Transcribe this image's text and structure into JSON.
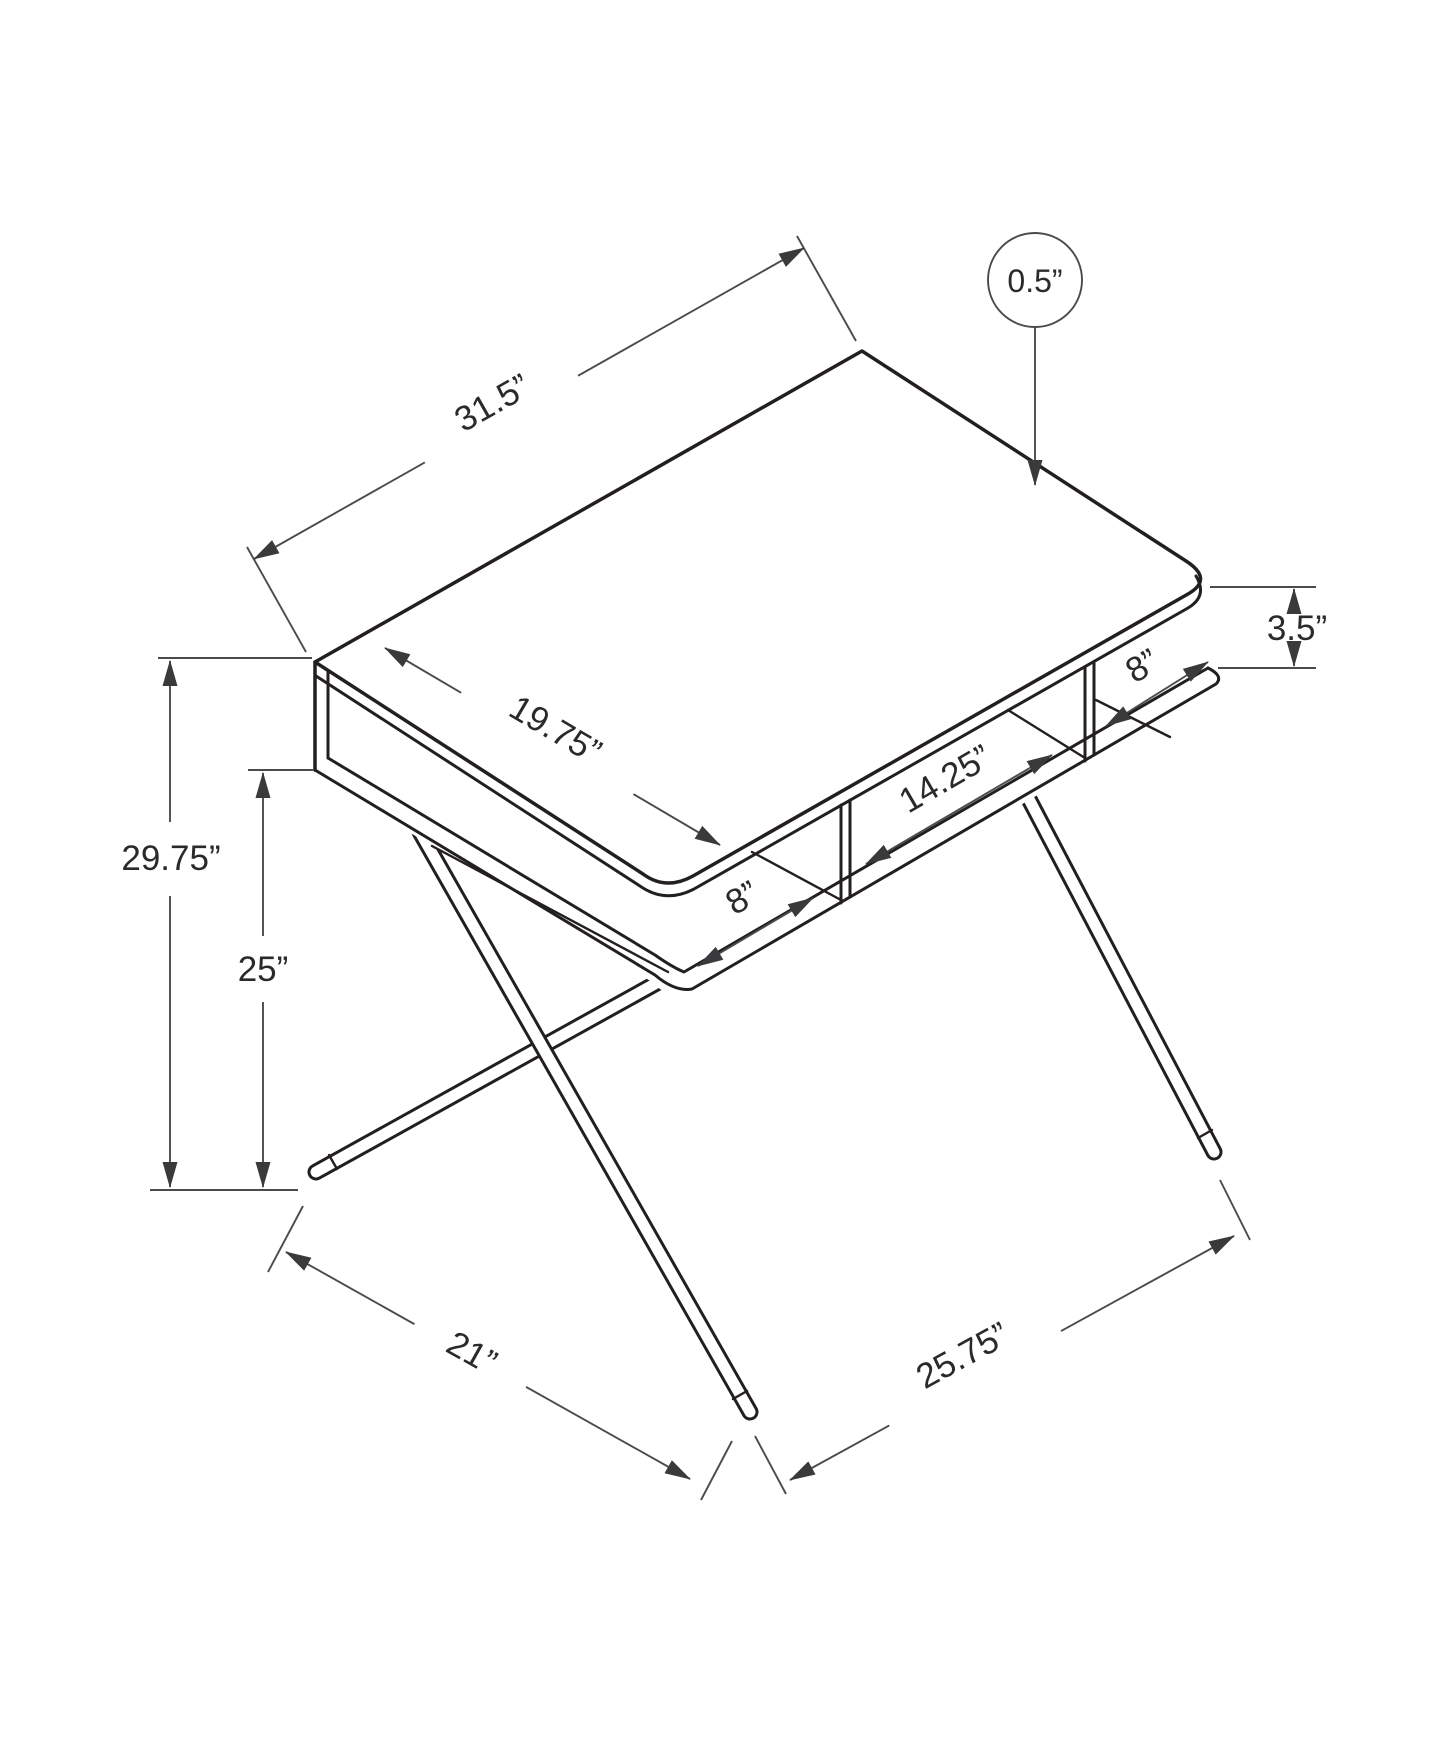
{
  "diagram": {
    "type": "furniture-dimension-line-drawing",
    "subject": "computer desk with open storage cubbies and X-shaped metal legs",
    "view": "isometric",
    "colors": {
      "background": "#ffffff",
      "structure_line": "#231f20",
      "dimension_line": "#4b4b4d",
      "text": "#2a2a2c"
    },
    "labels": {
      "top_width": "31.5”",
      "top_thickness": "0.5”",
      "top_depth": "19.75”",
      "cubby_height": "3.5”",
      "cubby_right_width": "8”",
      "cubby_middle_width": "14.25”",
      "cubby_left_width": "8”",
      "overall_height": "29.75”",
      "clearance_height": "25”",
      "foot_depth": "21”",
      "foot_width": "25.75”"
    },
    "dimensions": [
      {
        "name": "desk top width",
        "value": 31.5,
        "unit": "in"
      },
      {
        "name": "desk top thickness",
        "value": 0.5,
        "unit": "in"
      },
      {
        "name": "desk top depth",
        "value": 19.75,
        "unit": "in"
      },
      {
        "name": "cubby opening height",
        "value": 3.5,
        "unit": "in"
      },
      {
        "name": "right cubby width",
        "value": 8,
        "unit": "in"
      },
      {
        "name": "middle cubby width",
        "value": 14.25,
        "unit": "in"
      },
      {
        "name": "left cubby width",
        "value": 8,
        "unit": "in"
      },
      {
        "name": "overall height",
        "value": 29.75,
        "unit": "in"
      },
      {
        "name": "under-desk clearance height",
        "value": 25,
        "unit": "in"
      },
      {
        "name": "leg footprint depth",
        "value": 21,
        "unit": "in"
      },
      {
        "name": "leg footprint width",
        "value": 25.75,
        "unit": "in"
      }
    ]
  }
}
